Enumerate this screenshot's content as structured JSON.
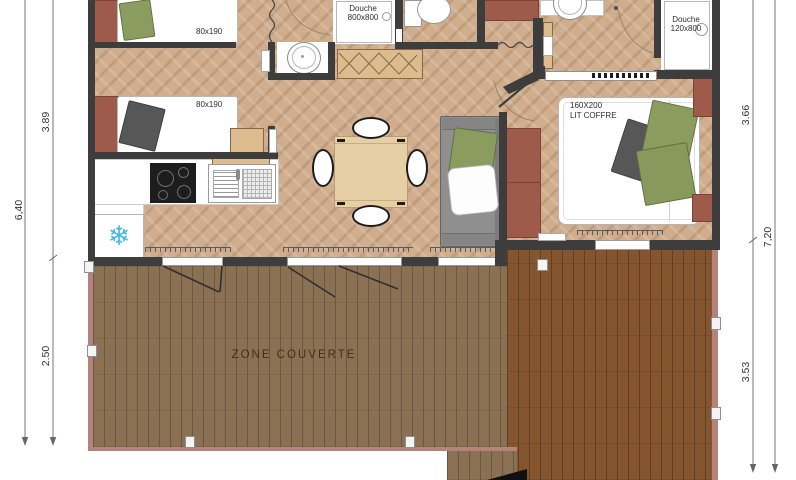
{
  "plan": {
    "title": "mobile-home floor plan with covered terrace",
    "dimensions_left": {
      "overall": "6,40",
      "house": "3.89",
      "terrace": "2.50"
    },
    "dimensions_right": {
      "overall": "7,20",
      "house": "3.66",
      "terrace": "3.53"
    },
    "labels": {
      "bed_small_1": "80x190",
      "bed_small_2": "80x190",
      "shower_main_line1": "Douche",
      "shower_main_line2": "800x800",
      "shower_ensuite_line1": "Douche",
      "shower_ensuite_line2": "120x800",
      "master_bed_line1": "160X200",
      "master_bed_line2": "LIT COFFRE",
      "terrace": "ZONE COUVERTE"
    },
    "icons": {
      "fridge_snowflake": "❄"
    },
    "colors": {
      "wall": "#3d3d3d",
      "floor_herringbone": "#cfad8d",
      "deck_light": "#8b7154",
      "deck_dark": "#84552f",
      "deck_edge": "#b5837b",
      "accent_maroon": "#9e5a4a",
      "pillow_green": "#8a9d5e",
      "pillow_gray": "#575757",
      "fridge_icon_blue": "#41b9e6",
      "closet_wood": "#dcbb8e"
    }
  }
}
